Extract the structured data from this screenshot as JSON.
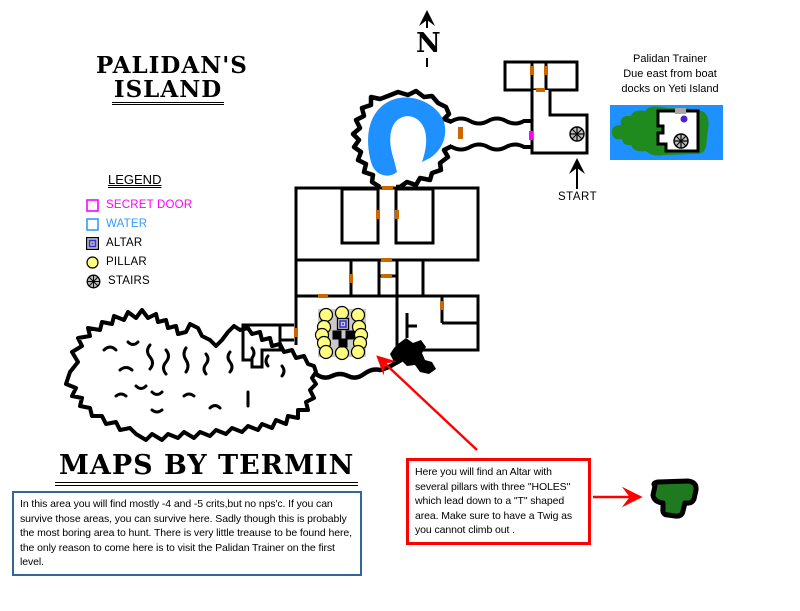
{
  "title": {
    "line1": "PALIDAN'S",
    "line2": "ISLAND"
  },
  "compass": {
    "label": "N"
  },
  "trainer_note": {
    "line1": "Palidan Trainer",
    "line2": "Due east from boat",
    "line3": "docks on Yeti Island"
  },
  "legend": {
    "title": "LEGEND",
    "items": [
      {
        "label": "SECRET DOOR",
        "symbol": "secret-door"
      },
      {
        "label": "WATER",
        "symbol": "water"
      },
      {
        "label": "ALTAR",
        "symbol": "altar"
      },
      {
        "label": "PILLAR",
        "symbol": "pillar"
      },
      {
        "label": "STAIRS",
        "symbol": "stairs"
      }
    ]
  },
  "map": {
    "start_label": "START",
    "doors": [
      [
        530,
        66,
        4,
        9
      ],
      [
        544,
        66,
        4,
        9
      ],
      [
        536,
        88,
        9,
        4
      ],
      [
        458,
        127,
        5,
        12
      ],
      [
        382,
        186,
        11,
        4
      ],
      [
        376,
        210,
        4,
        9
      ],
      [
        395,
        210,
        4,
        9
      ],
      [
        381,
        258,
        11,
        4
      ],
      [
        381,
        274,
        11,
        4
      ],
      [
        349,
        274,
        4,
        9
      ],
      [
        318,
        294,
        10,
        4
      ],
      [
        294,
        328,
        4,
        9
      ],
      [
        440,
        301,
        4,
        9
      ]
    ],
    "secret_doors": [
      [
        529,
        131,
        4,
        9
      ]
    ],
    "stairs_positions": [
      [
        577,
        134
      ],
      [
        681,
        141
      ]
    ],
    "altar_area": {
      "box": [
        318,
        309,
        48,
        48
      ],
      "altar": [
        343,
        324
      ],
      "pillars": [
        [
          326,
          315
        ],
        [
          342,
          313
        ],
        [
          358,
          315
        ],
        [
          324,
          327
        ],
        [
          359,
          327
        ],
        [
          322,
          335
        ],
        [
          361,
          335
        ],
        [
          324,
          343
        ],
        [
          360,
          343
        ],
        [
          326,
          352
        ],
        [
          342,
          353
        ],
        [
          358,
          352
        ]
      ],
      "holes": [
        [
          337,
          335
        ],
        [
          350,
          335
        ],
        [
          343,
          343
        ]
      ]
    }
  },
  "credit": "MAPS BY TERMIN",
  "notes": {
    "area_note": "In this area you will find mostly -4 and -5 crits,but no nps'c. If you can survive those areas, you can survive here. Sadly though this is probably the most boring area to hunt. There is very little treause to be found here, the only reason to come here is to visit the Palidan Trainer on the first level.",
    "altar_note": "Here you will find an Altar with several pillars with three \"HOLES\" which lead down to a \"T\" shaped area. Make sure to have a Twig as you cannot climb out ."
  },
  "colors": {
    "secret": "#FF00FF",
    "water_text": "#3399FF",
    "water_fill": "#1E90FF",
    "door": "#CC6600",
    "pillar": "#FFFF80",
    "stairs_fill": "#BBBBBB",
    "altar_gray": "#C9C9C9",
    "altar_blue": "#3333CC",
    "altar_purple": "#9933CC",
    "green": "#1F7A1F",
    "island_green": "#1F8B1F",
    "red": "#FF0000",
    "note_border": "#336699",
    "trainer_dot": "#4B23CC"
  }
}
